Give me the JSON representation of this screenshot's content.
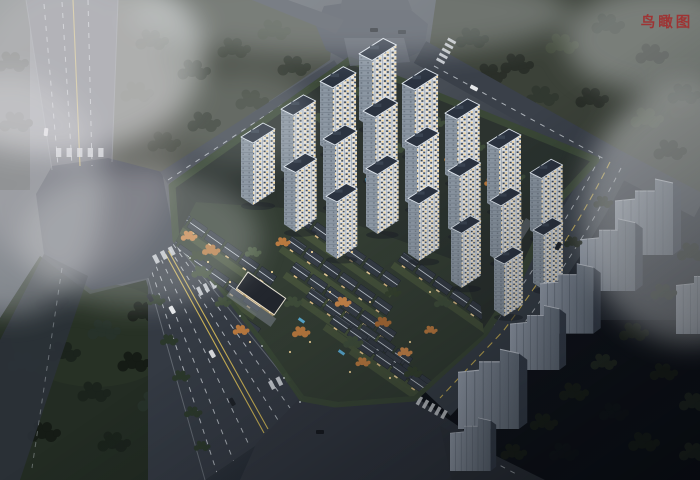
{
  "annotation": {
    "label": "鸟瞰图",
    "color": "#9e3434"
  },
  "palette": {
    "fog": "#e9ebed",
    "road": "#3c424b",
    "road_foggy": "#585c64",
    "lane_marking": "#d2d7dd",
    "lane_yellow": "#c9b055",
    "tower_facade": "#d6dce3",
    "tower_side": "#8b96a2",
    "tower_roof": "#2b3340",
    "window_warm": "#f7d89b",
    "villa_roof": "#343b44",
    "villa_ridge": "#ccd3db",
    "lawn": "#46523b",
    "tree_green": "#3f4d3a",
    "tree_autumn": "#b9793f",
    "field": "#232c23",
    "context_building": "#9ba4b2",
    "pool": "#55a7d0",
    "night_ground": "#0e1218"
  }
}
